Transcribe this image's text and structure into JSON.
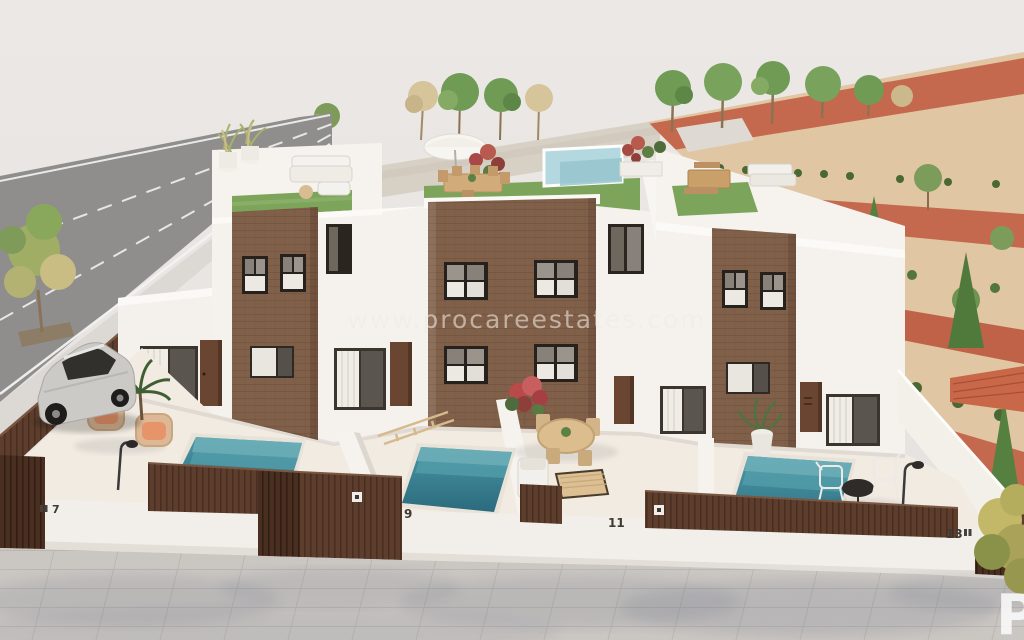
{
  "watermark": {
    "url_text": "www.procareestates.com",
    "corner_letter": "P"
  },
  "houses": {
    "numbers": [
      "7",
      "9",
      "11",
      "13"
    ]
  },
  "palette": {
    "sky": "#e9e5e2",
    "wall_white": "#f5f2ee",
    "brick_brown": "#81604a",
    "fence_brown": "#5d3e2d",
    "pool_teal": "#2f7d8f",
    "roof_pool_blue": "#b3d8df",
    "turf_green": "#7da45b",
    "road_gray": "#8f8e8c",
    "terracotta_path": "#c4694d",
    "garden_sand": "#e0c6a2",
    "pavement_gray": "#cac6c2"
  }
}
